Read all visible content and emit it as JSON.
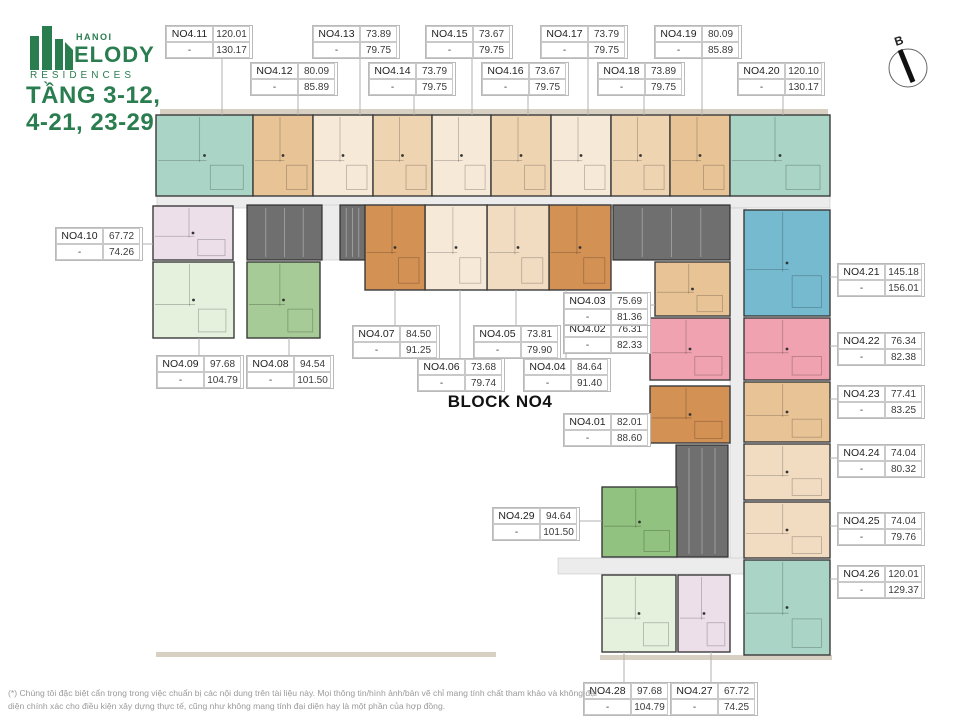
{
  "header": {
    "logo": {
      "hanoi": "HANOI",
      "melody": "ELODY",
      "residences": "RESIDENCES"
    },
    "floor_title_line1": "TẦNG 3-12,",
    "floor_title_line2": "4-21, 23-29"
  },
  "block_title": "BLOCK NO4",
  "footer_disclaimer": "(*) Chúng tôi đặc biệt cẩn trọng trong việc chuẩn bị các nội dung trên tài liệu này. Mọi thông tin/hình ảnh/bản vẽ chỉ mang tính chất tham khảo và không đại diện chính xác cho điều kiện xây dựng thực tế, cũng như không mang tính đại diện hay là một phần của hợp đồng.",
  "compass": {
    "cx": 908,
    "cy": 68,
    "r": 19,
    "label": "B"
  },
  "colors": {
    "brand_green": "#2a7d4f",
    "corridor": "#ececec",
    "core": "#6f6f6f",
    "core_lines": "#9b9b9b",
    "unit_border": "#3b3b3b",
    "leader": "#b0b0b0",
    "trim": "#d9d0c4",
    "palette": {
      "teal": "#a9d4c6",
      "blue": "#76bacf",
      "tan1": "#e8c396",
      "tan2": "#efd4b2",
      "cream1": "#f6e9d8",
      "cream2": "#f1dcc2",
      "dkorange": "#d49154",
      "rose": "#f0a2b0",
      "lav": "#ecdfe9",
      "ltgreen": "#e5f0dd",
      "green2": "#a7cb96",
      "green3": "#92c280"
    }
  },
  "floorplan": {
    "trims": [
      [
        160,
        109,
        668,
        6
      ],
      [
        156,
        652,
        340,
        5
      ],
      [
        600,
        655,
        232,
        5
      ]
    ],
    "corridors": [
      [
        157,
        196,
        673,
        12
      ],
      [
        322,
        205,
        18,
        55
      ],
      [
        730,
        208,
        16,
        352
      ],
      [
        558,
        558,
        188,
        16
      ]
    ],
    "cores": [
      [
        247,
        205,
        75,
        55
      ],
      [
        340,
        205,
        25,
        55
      ],
      [
        613,
        205,
        117,
        55
      ],
      [
        676,
        445,
        52,
        112
      ]
    ],
    "units": [
      {
        "id": "NO4.01",
        "areas": [
          "82.01",
          "88.60"
        ],
        "dash": "-",
        "label": [
          563,
          413
        ],
        "rect": [
          650,
          386,
          80,
          57
        ],
        "color": "dkorange",
        "leader": [
          647,
          427,
          650,
          427
        ]
      },
      {
        "id": "NO4.02",
        "areas": [
          "76.31",
          "82.33"
        ],
        "dash": "-",
        "label": [
          563,
          320
        ],
        "rect": [
          650,
          318,
          80,
          62
        ],
        "color": "rose",
        "leader": [
          647,
          334,
          650,
          334
        ]
      },
      {
        "id": "NO4.03",
        "areas": [
          "75.69",
          "81.36"
        ],
        "dash": "-",
        "label": [
          563,
          292
        ],
        "rect": [
          655,
          262,
          75,
          54
        ],
        "color": "tan1",
        "leader": [
          647,
          305,
          655,
          305
        ]
      },
      {
        "id": "NO4.04",
        "areas": [
          "84.64",
          "91.40"
        ],
        "dash": "-",
        "label": [
          523,
          358
        ],
        "rect": [
          549,
          205,
          62,
          85
        ],
        "color": "dkorange",
        "leader": [
          566,
          358,
          566,
          290
        ]
      },
      {
        "id": "NO4.05",
        "areas": [
          "73.81",
          "79.90"
        ],
        "dash": "-",
        "label": [
          473,
          325
        ],
        "rect": [
          487,
          205,
          62,
          85
        ],
        "color": "cream2",
        "leader": [
          516,
          325,
          516,
          290
        ]
      },
      {
        "id": "NO4.06",
        "areas": [
          "73.68",
          "79.74"
        ],
        "dash": "-",
        "label": [
          417,
          358
        ],
        "rect": [
          425,
          205,
          62,
          85
        ],
        "color": "cream1",
        "leader": [
          460,
          358,
          460,
          290
        ]
      },
      {
        "id": "NO4.07",
        "areas": [
          "84.50",
          "91.25"
        ],
        "dash": "-",
        "label": [
          352,
          325
        ],
        "rect": [
          365,
          205,
          60,
          85
        ],
        "color": "dkorange",
        "leader": [
          395,
          325,
          395,
          290
        ]
      },
      {
        "id": "NO4.08",
        "areas": [
          "94.54",
          "101.50"
        ],
        "dash": "-",
        "label": [
          246,
          355
        ],
        "rect": [
          247,
          262,
          73,
          76
        ],
        "color": "green2",
        "leader": [
          289,
          355,
          289,
          338
        ]
      },
      {
        "id": "NO4.09",
        "areas": [
          "97.68",
          "104.79"
        ],
        "dash": "-",
        "label": [
          156,
          355
        ],
        "rect": [
          153,
          262,
          81,
          76
        ],
        "color": "ltgreen",
        "leader": [
          199,
          355,
          199,
          338
        ]
      },
      {
        "id": "NO4.10",
        "areas": [
          "67.72",
          "74.26"
        ],
        "dash": "-",
        "label": [
          55,
          227
        ],
        "rect": [
          153,
          206,
          80,
          54
        ],
        "color": "lav",
        "leader": [
          141,
          244,
          153,
          244
        ]
      },
      {
        "id": "NO4.11",
        "areas": [
          "120.01",
          "130.17"
        ],
        "dash": "-",
        "label": [
          165,
          25
        ],
        "rect": [
          156,
          115,
          97,
          81
        ],
        "color": "teal",
        "leader": [
          222,
          59,
          222,
          115
        ]
      },
      {
        "id": "NO4.12",
        "areas": [
          "80.09",
          "85.89"
        ],
        "dash": "-",
        "label": [
          250,
          62
        ],
        "rect": [
          253,
          115,
          60,
          81
        ],
        "color": "tan1",
        "leader": [
          298,
          96,
          298,
          115
        ]
      },
      {
        "id": "NO4.13",
        "areas": [
          "73.89",
          "79.75"
        ],
        "dash": "-",
        "label": [
          312,
          25
        ],
        "rect": [
          313,
          115,
          60,
          81
        ],
        "color": "cream1",
        "leader": [
          360,
          59,
          360,
          115
        ]
      },
      {
        "id": "NO4.14",
        "areas": [
          "73.79",
          "79.75"
        ],
        "dash": "-",
        "label": [
          368,
          62
        ],
        "rect": [
          373,
          115,
          59,
          81
        ],
        "color": "tan2",
        "leader": [
          414,
          96,
          414,
          115
        ]
      },
      {
        "id": "NO4.15",
        "areas": [
          "73.67",
          "79.75"
        ],
        "dash": "-",
        "label": [
          425,
          25
        ],
        "rect": [
          432,
          115,
          59,
          81
        ],
        "color": "cream1",
        "leader": [
          472,
          59,
          472,
          115
        ]
      },
      {
        "id": "NO4.16",
        "areas": [
          "73.67",
          "79.75"
        ],
        "dash": "-",
        "label": [
          481,
          62
        ],
        "rect": [
          491,
          115,
          60,
          81
        ],
        "color": "tan2",
        "leader": [
          528,
          96,
          528,
          115
        ]
      },
      {
        "id": "NO4.17",
        "areas": [
          "73.79",
          "79.75"
        ],
        "dash": "-",
        "label": [
          540,
          25
        ],
        "rect": [
          551,
          115,
          60,
          81
        ],
        "color": "cream1",
        "leader": [
          588,
          59,
          588,
          115
        ]
      },
      {
        "id": "NO4.18",
        "areas": [
          "73.89",
          "79.75"
        ],
        "dash": "-",
        "label": [
          597,
          62
        ],
        "rect": [
          611,
          115,
          59,
          81
        ],
        "color": "tan2",
        "leader": [
          644,
          96,
          644,
          115
        ]
      },
      {
        "id": "NO4.19",
        "areas": [
          "80.09",
          "85.89"
        ],
        "dash": "-",
        "label": [
          654,
          25
        ],
        "rect": [
          670,
          115,
          60,
          81
        ],
        "color": "tan1",
        "leader": [
          702,
          59,
          702,
          115
        ]
      },
      {
        "id": "NO4.20",
        "areas": [
          "120.10",
          "130.17"
        ],
        "dash": "-",
        "label": [
          737,
          62
        ],
        "rect": [
          730,
          115,
          100,
          81
        ],
        "color": "teal",
        "leader": [
          783,
          96,
          783,
          115
        ]
      },
      {
        "id": "NO4.21",
        "areas": [
          "145.18",
          "156.01"
        ],
        "dash": "-",
        "label": [
          837,
          263
        ],
        "rect": [
          744,
          210,
          86,
          106
        ],
        "color": "blue",
        "leader": [
          830,
          277,
          837,
          277
        ]
      },
      {
        "id": "NO4.22",
        "areas": [
          "76.34",
          "82.38"
        ],
        "dash": "-",
        "label": [
          837,
          332
        ],
        "rect": [
          744,
          318,
          86,
          62
        ],
        "color": "rose",
        "leader": [
          830,
          346,
          837,
          346
        ]
      },
      {
        "id": "NO4.23",
        "areas": [
          "77.41",
          "83.25"
        ],
        "dash": "-",
        "label": [
          837,
          385
        ],
        "rect": [
          744,
          382,
          86,
          60
        ],
        "color": "tan1",
        "leader": [
          830,
          399,
          837,
          399
        ]
      },
      {
        "id": "NO4.24",
        "areas": [
          "74.04",
          "80.32"
        ],
        "dash": "-",
        "label": [
          837,
          444
        ],
        "rect": [
          744,
          444,
          86,
          56
        ],
        "color": "cream2",
        "leader": [
          830,
          458,
          837,
          458
        ]
      },
      {
        "id": "NO4.25",
        "areas": [
          "74.04",
          "79.76"
        ],
        "dash": "-",
        "label": [
          837,
          512
        ],
        "rect": [
          744,
          502,
          86,
          56
        ],
        "color": "cream2",
        "leader": [
          830,
          526,
          837,
          526
        ]
      },
      {
        "id": "NO4.26",
        "areas": [
          "120.01",
          "129.37"
        ],
        "dash": "-",
        "label": [
          837,
          565
        ],
        "rect": [
          744,
          560,
          86,
          95
        ],
        "color": "teal",
        "leader": [
          830,
          579,
          837,
          579
        ]
      },
      {
        "id": "NO4.27",
        "areas": [
          "67.72",
          "74.25"
        ],
        "dash": "-",
        "label": [
          670,
          682
        ],
        "rect": [
          678,
          575,
          52,
          77
        ],
        "color": "lav",
        "leader": [
          711,
          682,
          711,
          652
        ]
      },
      {
        "id": "NO4.28",
        "areas": [
          "97.68",
          "104.79"
        ],
        "dash": "-",
        "label": [
          583,
          682
        ],
        "rect": [
          602,
          575,
          74,
          77
        ],
        "color": "ltgreen",
        "leader": [
          624,
          682,
          624,
          652
        ]
      },
      {
        "id": "NO4.29",
        "areas": [
          "94.64",
          "101.50"
        ],
        "dash": "-",
        "label": [
          492,
          507
        ],
        "rect": [
          602,
          487,
          75,
          70
        ],
        "color": "green3",
        "leader": [
          576,
          521,
          602,
          521
        ]
      }
    ]
  }
}
